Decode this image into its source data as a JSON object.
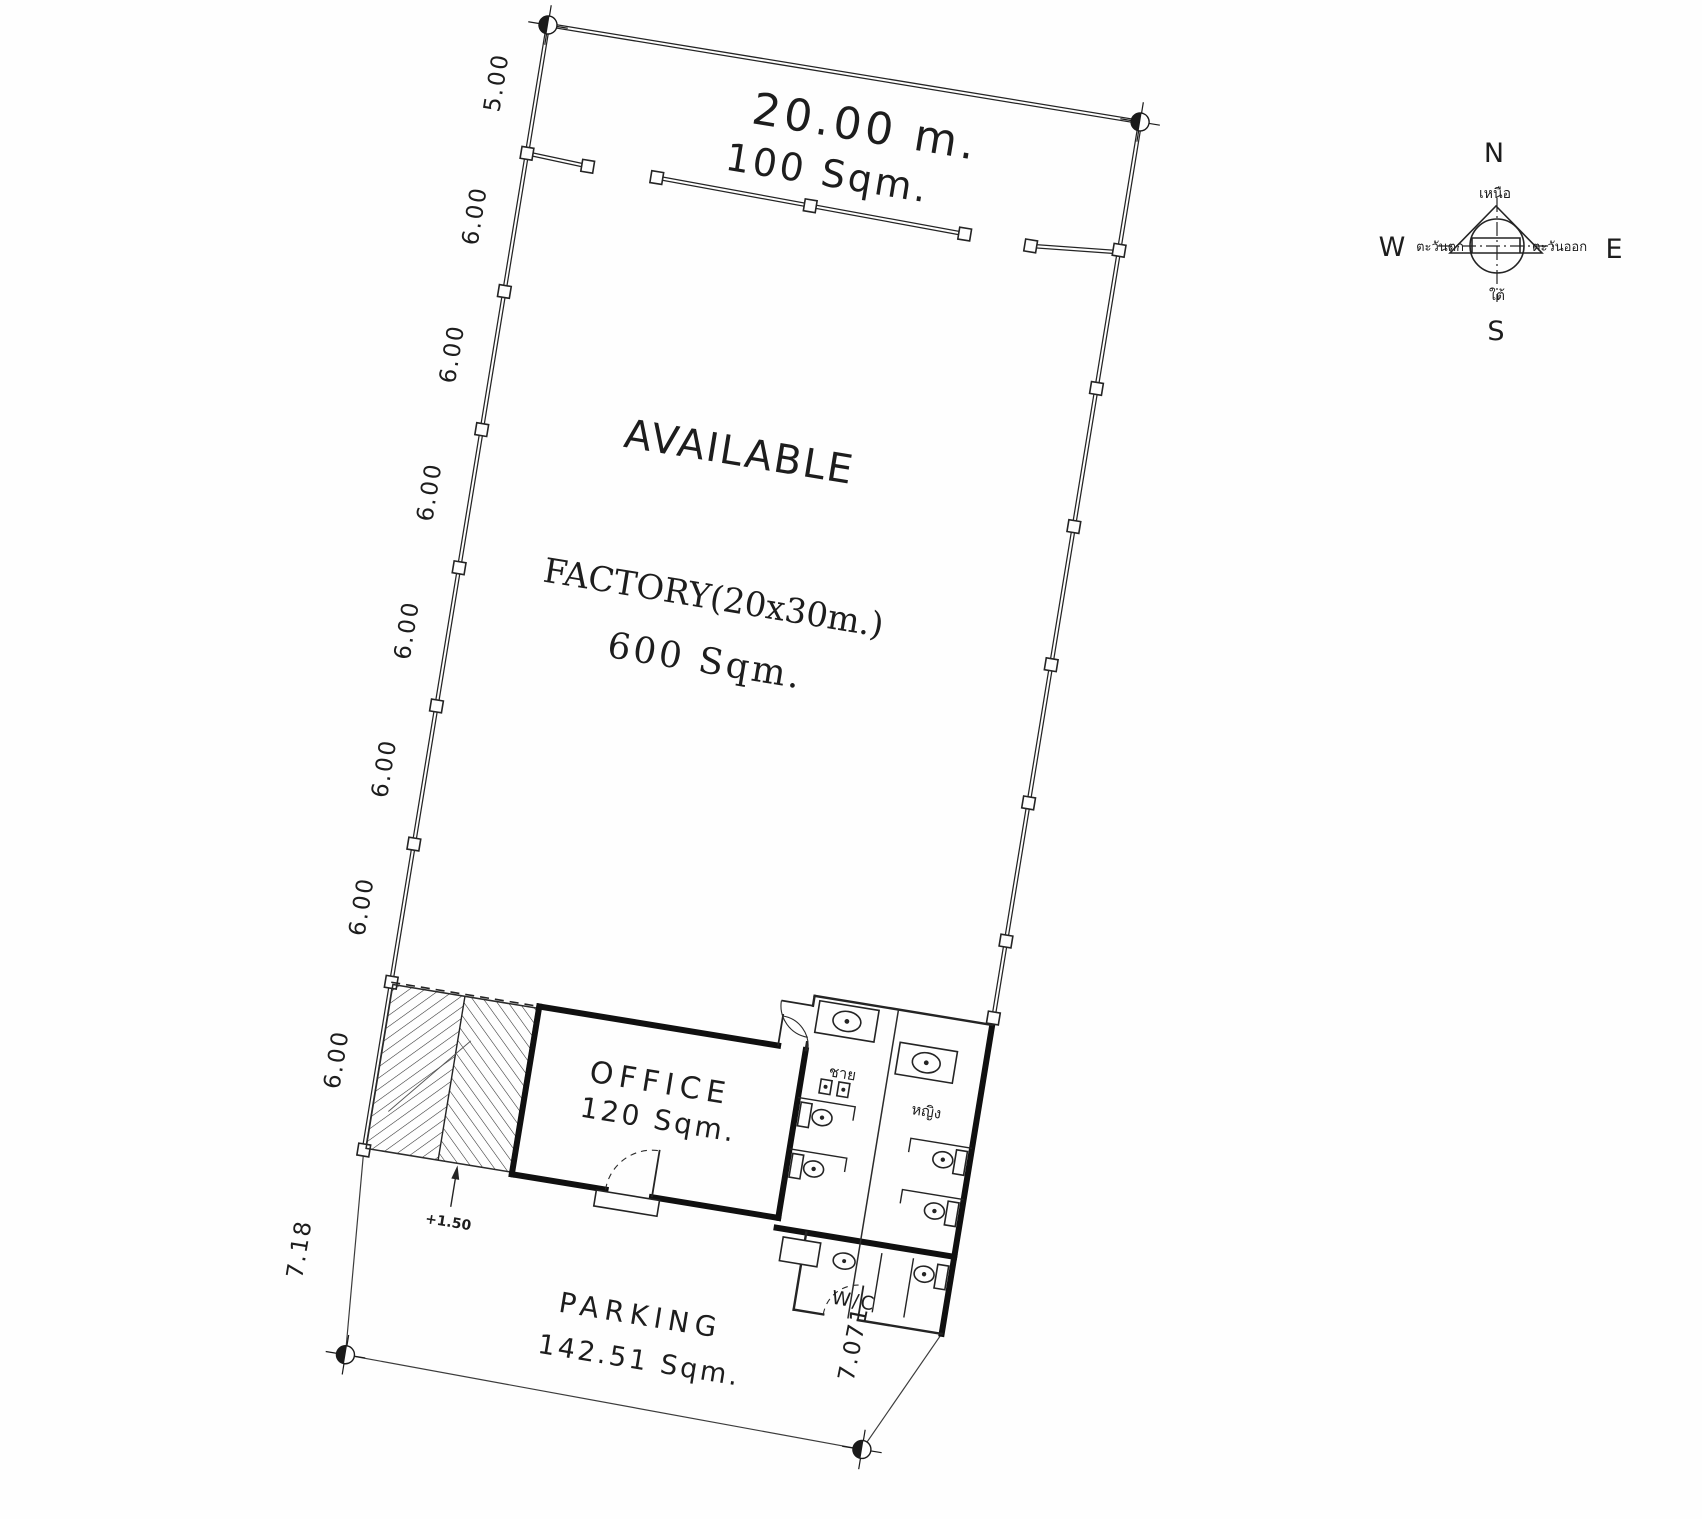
{
  "plan": {
    "top": {
      "width_label": "20.00 m.",
      "area_label": "100 Sqm."
    },
    "factory": {
      "available_label": "AVAILABLE",
      "name_label": "FACTORY(20x30m.)",
      "area_label": "600 Sqm."
    },
    "office": {
      "name_label": "OFFICE",
      "area_label": "120 Sqm."
    },
    "toilets": {
      "wc_label": "W/C",
      "mens_label": "ชาย",
      "womens_label": "หญิง"
    },
    "parking": {
      "name_label": "PARKING",
      "area_label": "142.51 Sqm."
    },
    "ramp": {
      "level_label": "+1.50"
    },
    "dimensions": {
      "west": [
        "5.00",
        "6.00",
        "6.00",
        "6.00",
        "6.00",
        "6.00",
        "6.00",
        "6.00"
      ],
      "west_parking": "7.18",
      "east_parking": "7.071"
    }
  },
  "compass": {
    "north": "N",
    "south": "S",
    "east": "E",
    "west": "W",
    "north_thai": "เหนือ",
    "south_thai": "ใต้",
    "east_thai": "ตะวันออก",
    "west_thai": "ตะวันตก"
  },
  "colors": {
    "ink": "#242424",
    "paper": "#fefefe"
  }
}
